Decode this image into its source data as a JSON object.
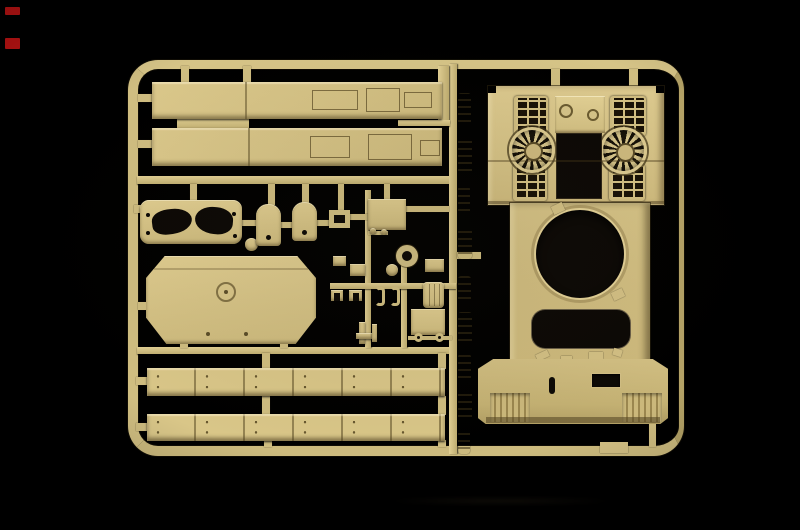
{
  "scene": {
    "type": "photograph",
    "subject": "tan injection-molded model kit sprue (tank hull and detail parts) on a black studio background",
    "visible_text": "none",
    "colors": {
      "bg": "#000000",
      "plastic": "#d6c386",
      "plastic-hi": "#ecd9a0",
      "plastic-lo": "#8f7c4c",
      "opening": "#0c0906",
      "red": "#c41414"
    }
  },
  "marks": {
    "description": "two small red dashes at the upper left edge of the photo",
    "count": 2
  },
  "sprue": {
    "frame": "rounded-rectangle runner frame with internal horizontal and vertical runners",
    "inventory": [
      {
        "name": "fender-panel",
        "count": 2,
        "desc": "long flat side panels with hatch outline engraving, upper left"
      },
      {
        "name": "mantlet-plate",
        "count": 1,
        "desc": "rounded plate with two kidney-shaped cutouts and rivet holes"
      },
      {
        "name": "tombstone-cover",
        "count": 2,
        "desc": "arched rectangular covers with a small hole"
      },
      {
        "name": "square-frame-part",
        "count": 1,
        "desc": "small square frame with square opening"
      },
      {
        "name": "hatch-block",
        "count": 1,
        "desc": "solid rectangular hatch part"
      },
      {
        "name": "hull-belly-plate",
        "count": 1,
        "desc": "octagonal plate with central ring detail and bolt holes"
      },
      {
        "name": "ring-part",
        "count": 1,
        "desc": "small donut/ring with satellite disc"
      },
      {
        "name": "stowage-box",
        "count": 1,
        "desc": "ribbed box part"
      },
      {
        "name": "c-clamp",
        "count": 2,
        "desc": "small C-shaped clamps"
      },
      {
        "name": "eyelet",
        "count": 2,
        "desc": "small towing eyelets on a short runner"
      },
      {
        "name": "track-guard-strip",
        "count": 2,
        "desc": "long segmented strips with bolt pairs, lower left"
      },
      {
        "name": "small-fitting-column",
        "count": 9,
        "desc": "column of tiny knobby fittings along the central vertical runner"
      },
      {
        "name": "upper-hull",
        "count": 1,
        "desc": "large tank upper hull: engine deck with 2 cooling fans, 4 louvered grilles, filler-cap panel, open engine bay, round turret-ring opening, rounded crew hatch opening, flared glacis with vision slot, port opening and ribbed corner vents"
      }
    ],
    "feature_counts": {
      "cooling_fans": 2,
      "louver_grilles": 4,
      "filler_caps": 2,
      "turret_ring_openings": 1,
      "crew_hatch_openings": 1
    }
  }
}
